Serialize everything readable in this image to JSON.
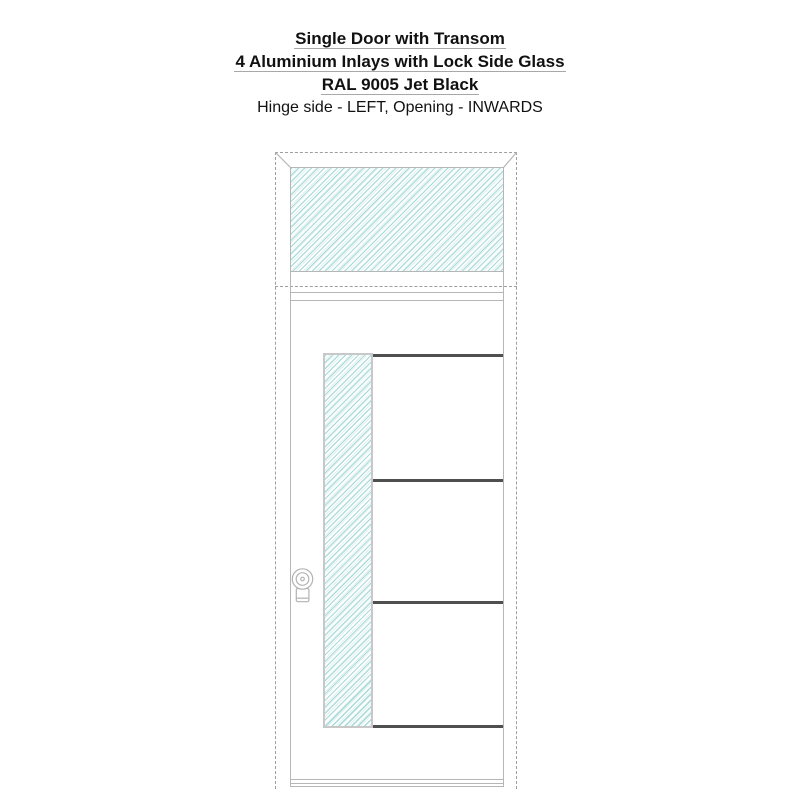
{
  "title": {
    "line1": "Single Door with Transom",
    "line2": "4 Aluminium Inlays with Lock Side Glass",
    "line3": "RAL 9005 Jet Black",
    "subtitle": "Hinge side - LEFT, Opening - INWARDS"
  },
  "configuration": {
    "product": "Single Door with Transom",
    "design": "4 Aluminium Inlays with Lock Side Glass",
    "color_name": "RAL 9005 Jet Black",
    "hinge_side": "LEFT",
    "opening": "INWARDS",
    "inlay_count": 4
  },
  "diagram": {
    "type": "door-front-elevation",
    "parts": [
      "door-frame-dashed-outline",
      "transom-glass-panel",
      "door-leaf",
      "lock-side-glass-strip",
      "aluminium-inlay-1",
      "aluminium-inlay-2",
      "aluminium-inlay-3",
      "aluminium-inlay-4",
      "door-knob",
      "threshold"
    ]
  },
  "colors": {
    "background": "#ffffff",
    "text": "#111111",
    "title_underline": "#a8a8a8",
    "frame_line": "#b6b6b6",
    "frame_dash": "#9e9e9e",
    "strip_border": "#c8c8c8",
    "inlay": "#4f4f4f",
    "hardware": "#b3b3b3",
    "hatch_primary": "#a9dada",
    "hatch_secondary": "#def1f1"
  }
}
